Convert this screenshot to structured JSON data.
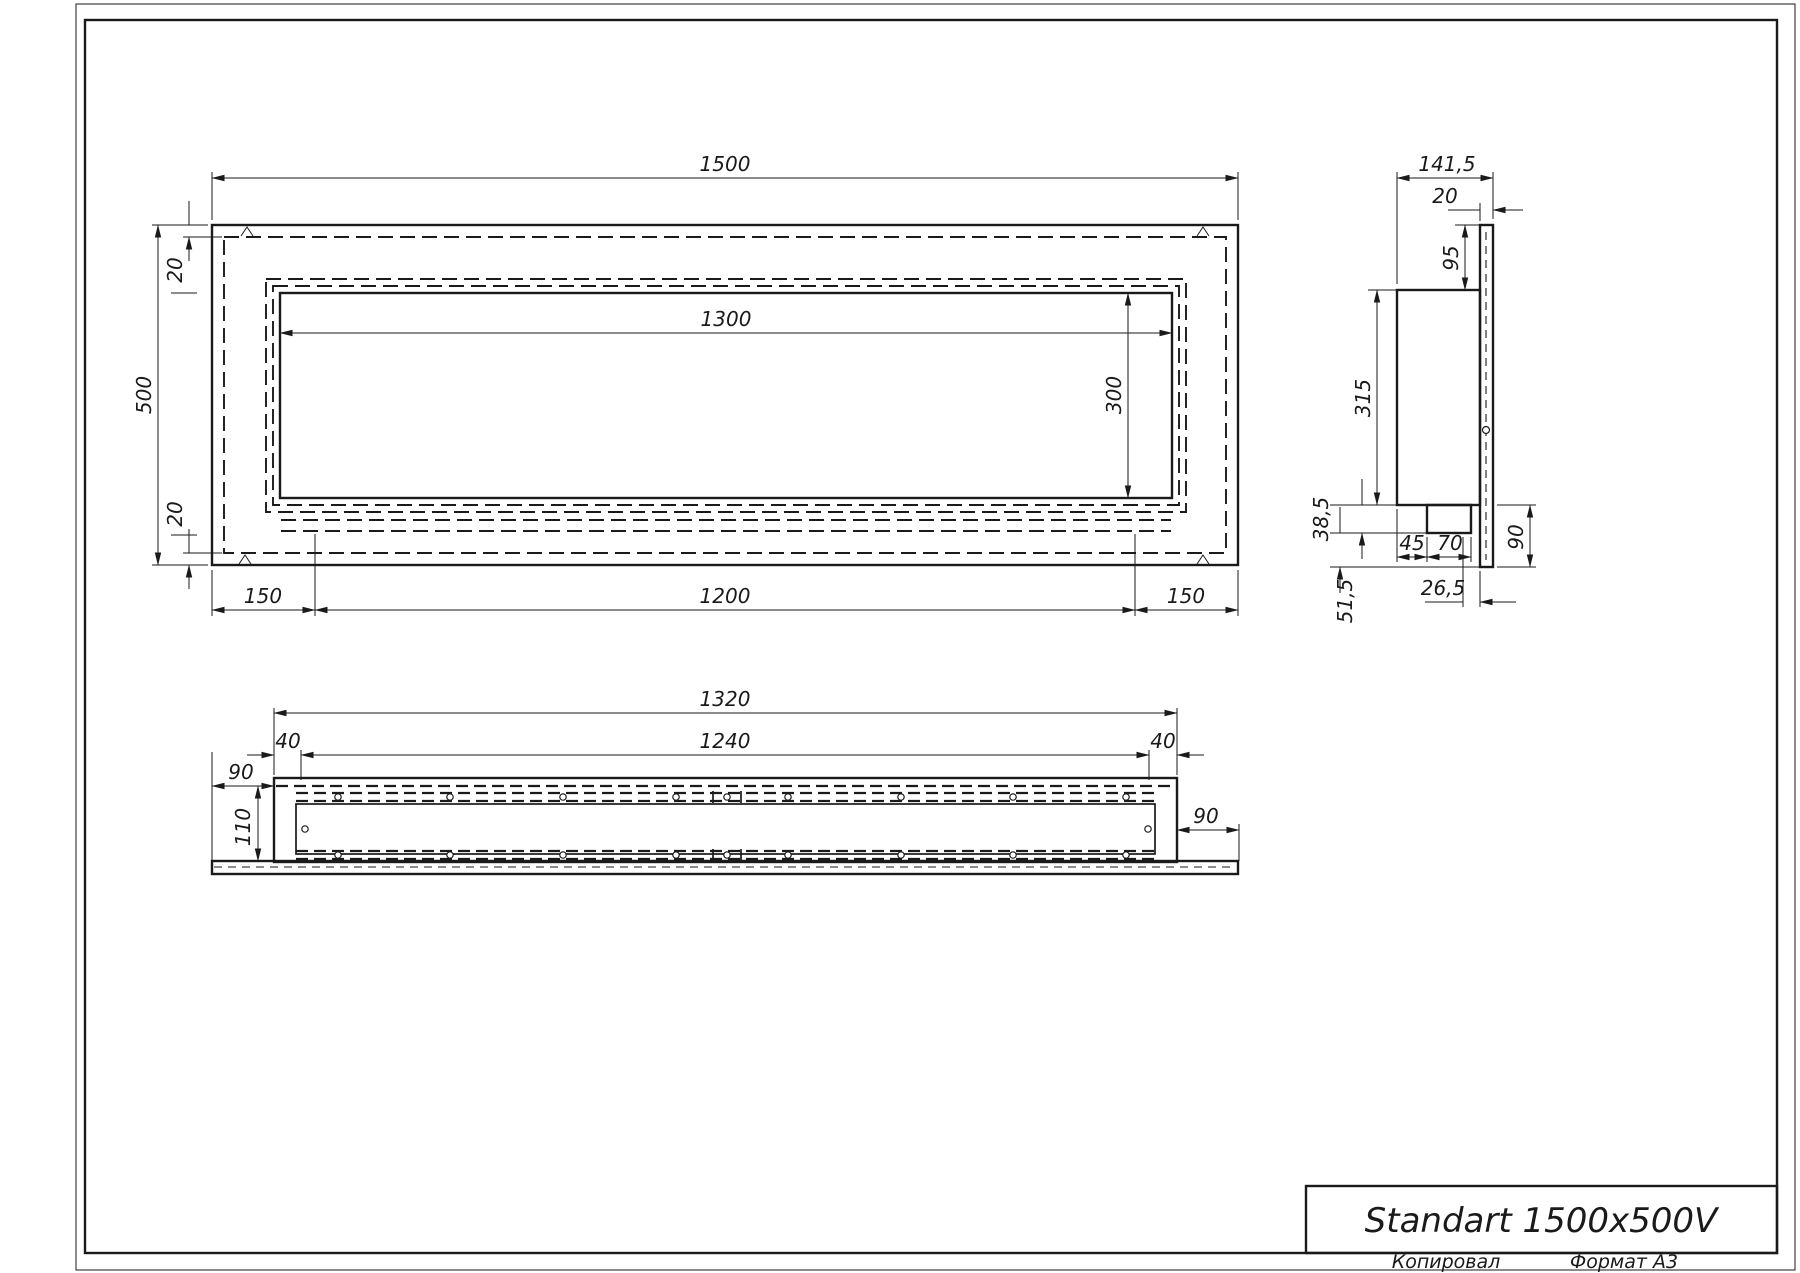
{
  "colors": {
    "ink": "#1a1a1a",
    "paper": "#ffffff"
  },
  "title_block": {
    "title": "Standart 1500x500V",
    "copied_by": "Копировал",
    "format": "Формат А3"
  },
  "views": {
    "front": {
      "width": "1500",
      "height": "500",
      "top_inset": "20",
      "bottom_inset": "20",
      "opening_width": "1300",
      "opening_height": "300",
      "margin_left": "150",
      "tray_width": "1200",
      "margin_right": "150"
    },
    "side": {
      "depth": "141,5",
      "front_plate": "20",
      "top_offset": "95",
      "body_height": "315",
      "step": "38,5",
      "tray_inset": "45",
      "tray_width": "70",
      "front_gap": "26,5",
      "bottom_height": "51,5",
      "mount_height": "90"
    },
    "bottom": {
      "body_width": "1320",
      "inner_width": "1240",
      "corner_left": "40",
      "corner_right": "40",
      "overhang_left": "90",
      "overhang_right": "90",
      "depth": "110"
    }
  }
}
